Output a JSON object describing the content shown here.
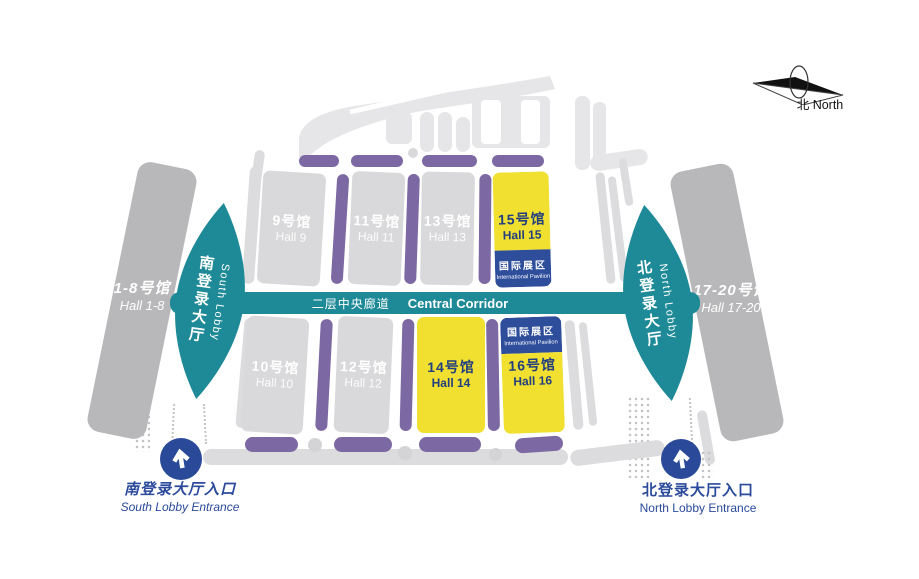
{
  "compass": {
    "label": "北 North"
  },
  "corridor": {
    "zh": "二层中央廊道",
    "en": "Central Corridor"
  },
  "outer_halls": {
    "left": {
      "zh": "1-8号馆",
      "en": "Hall 1-8",
      "highlight": false
    },
    "right": {
      "zh": "17-20号馆",
      "en": "Hall 17-20",
      "highlight": false
    }
  },
  "lobbies": {
    "south": {
      "en": "South Lobby",
      "zh": "南登录大厅"
    },
    "north": {
      "en": "North Lobby",
      "zh": "北登录大厅"
    }
  },
  "halls": {
    "h9": {
      "zh": "9号馆",
      "en": "Hall 9",
      "highlight": false
    },
    "h11": {
      "zh": "11号馆",
      "en": "Hall 11",
      "highlight": false
    },
    "h13": {
      "zh": "13号馆",
      "en": "Hall 13",
      "highlight": false
    },
    "h15": {
      "zh": "15号馆",
      "en": "Hall 15",
      "highlight": true,
      "has_badge": true
    },
    "h10": {
      "zh": "10号馆",
      "en": "Hall 10",
      "highlight": false
    },
    "h12": {
      "zh": "12号馆",
      "en": "Hall 12",
      "highlight": false
    },
    "h14": {
      "zh": "14号馆",
      "en": "Hall 14",
      "highlight": true,
      "has_badge": false
    },
    "h16": {
      "zh": "16号馆",
      "en": "Hall 16",
      "highlight": true,
      "has_badge": true
    }
  },
  "badge": {
    "zh": "国际展区",
    "en": "International Pavilion"
  },
  "entrances": {
    "south": {
      "zh": "南登录大厅入口",
      "en": "South Lobby Entrance"
    },
    "north": {
      "zh": "北登录大厅入口",
      "en": "North Lobby Entrance"
    }
  },
  "colors": {
    "teal": "#1e8a97",
    "purple": "#7c68a3",
    "hall_gray": "#d9d9db",
    "roof_gray": "#e6e6e8",
    "band_gray": "#b8b8ba",
    "highlight_yellow": "#f1e02f",
    "badge_blue": "#2e4d9b",
    "entrance_blue": "#2a4a99",
    "hall_text_dark": "#233f7f",
    "label_white": "#ffffff"
  }
}
